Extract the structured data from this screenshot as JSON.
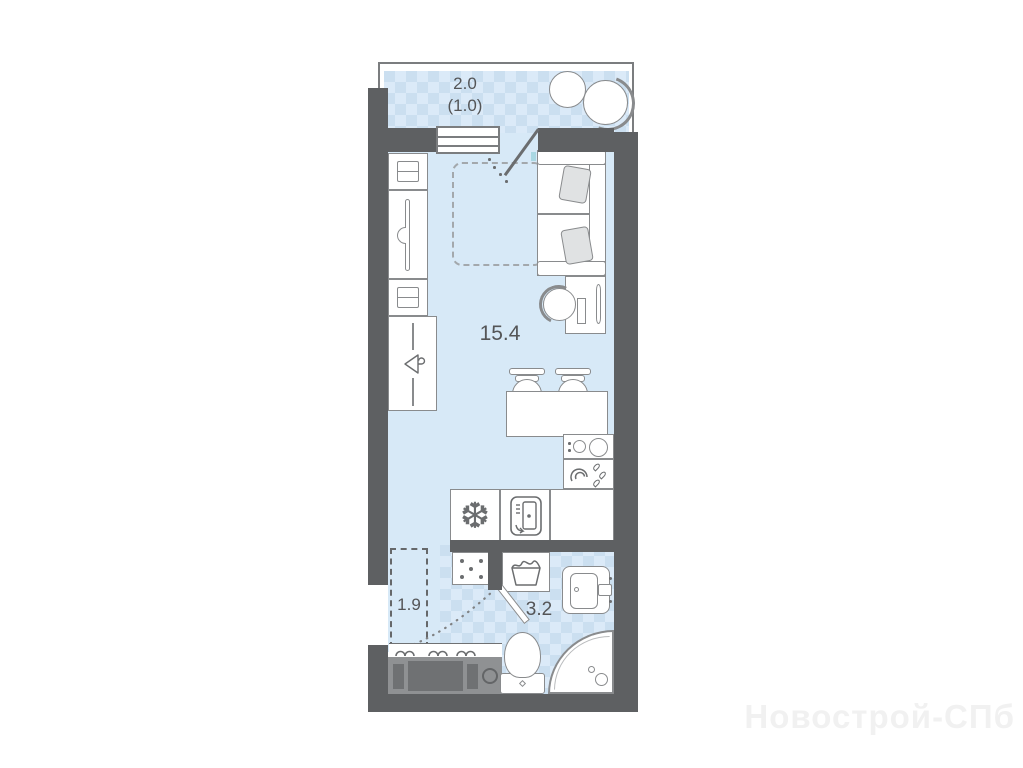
{
  "watermark": {
    "text": "Новострой-СПб"
  },
  "plan": {
    "balcony": {
      "area": "2.0",
      "reduced_area": "(1.0)"
    },
    "room": {
      "area": "15.4"
    },
    "hallway": {
      "area": "1.9"
    },
    "bathroom": {
      "area": "3.2"
    }
  },
  "icons": {
    "fridge_snowflake": "❆"
  },
  "colors": {
    "wall": "#5e6062",
    "wallLight": "#7b7d7f",
    "stroke": "#898b8d",
    "strokeDark": "#6b6d6f",
    "room": "#d7e9f7",
    "patternBase": "#cbdff0",
    "patternDiamond": "#dbeaf8",
    "teal": "#a9d7e2",
    "pillow": "#e0e2e3",
    "furnGray": "#8f9193",
    "furnDark": "#6f7173",
    "label": "#545557",
    "watermark": "#f1f1f1"
  }
}
